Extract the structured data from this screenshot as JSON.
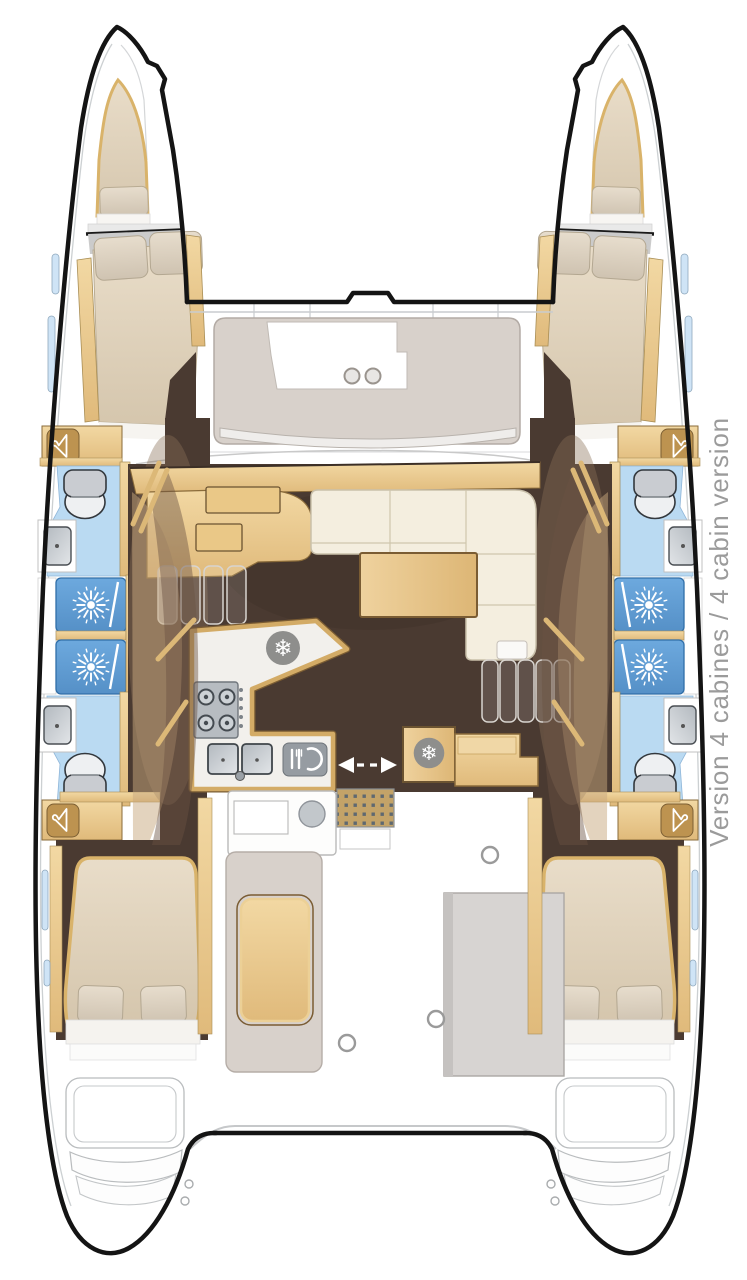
{
  "caption": {
    "text": "Version 4 cabines / 4 cabin version",
    "color": "#9b9b9b"
  },
  "icons": {
    "snowflake_glyph": "❄",
    "semantic": [
      "hanger-icon",
      "snowflake-icon",
      "shower-jet-icon",
      "toilet-icon",
      "sink-icon",
      "stove-icon",
      "cutlery-plate-icon",
      "slide-direction-arrow-icon",
      "cup-holder-icon"
    ]
  },
  "palette": {
    "hull_outline": "#141414",
    "wood": "#e8c488",
    "wood_edge": "#8a6b3a",
    "floor_dark": "#4a3a31",
    "bathroom_floor": "#badaf2",
    "shower_blue": "#5e9bd3",
    "upholstery_cream": "#f4eedf",
    "cushion_greige": "#d8d1cb",
    "bed_beige": "#e0d3bd",
    "fixture_gray": "#c9ccd1",
    "mat_tan": "#c3a368",
    "window_blue": "#cfe4f6",
    "icon_gray": "#8e8e8c"
  }
}
